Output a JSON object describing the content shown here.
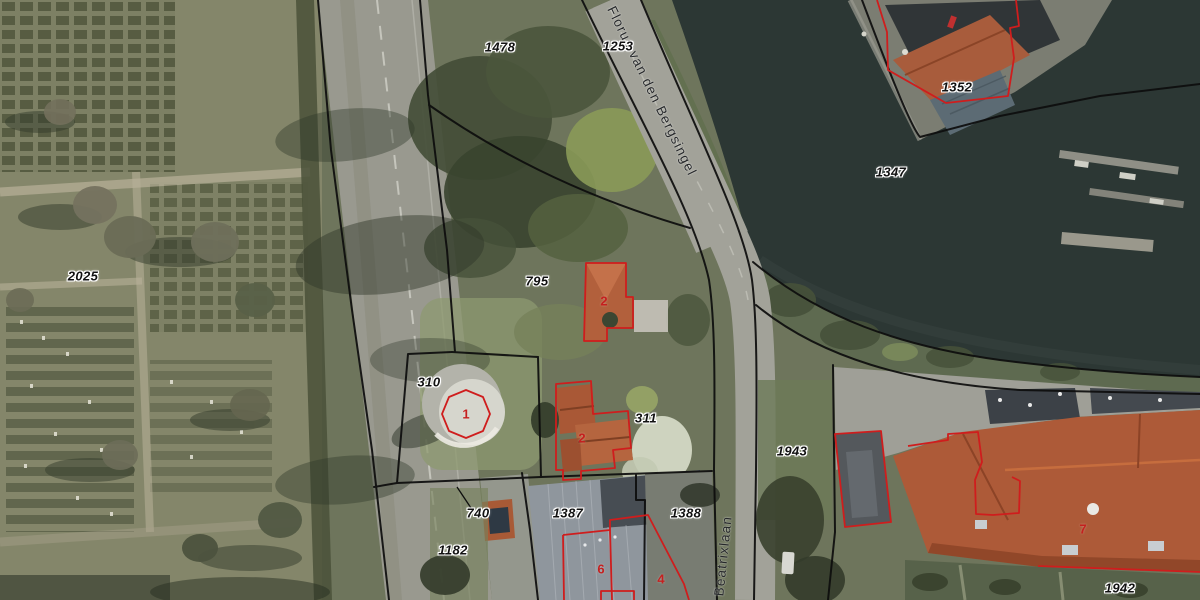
{
  "map": {
    "type_note": "aerial photo with cadastral parcel overlay",
    "streets": [
      {
        "name": "Florus van den Bergsingel"
      },
      {
        "name": "Beatrixlaan"
      }
    ],
    "parcel_labels": [
      {
        "text": "1478"
      },
      {
        "text": "1253"
      },
      {
        "text": "2025"
      },
      {
        "text": "795"
      },
      {
        "text": "310"
      },
      {
        "text": "311"
      },
      {
        "text": "1943"
      },
      {
        "text": "740"
      },
      {
        "text": "1387"
      },
      {
        "text": "1388"
      },
      {
        "text": "1182"
      },
      {
        "text": "1942"
      },
      {
        "text": "1352"
      },
      {
        "text": "1347"
      }
    ],
    "building_numbers": [
      {
        "text": "1"
      },
      {
        "text": "2"
      },
      {
        "text": "2"
      },
      {
        "text": "6"
      },
      {
        "text": "4"
      },
      {
        "text": "7"
      }
    ],
    "colors": {
      "parcel_boundary": "#0d0d0d",
      "building_outline": "#cf1d1d",
      "building_number_text": "#c5201f",
      "parcel_label_text": "#111111",
      "label_halo": "#ffffff",
      "street_text": "#26282a",
      "water": "#2c3734",
      "road": "#a2a299"
    }
  }
}
